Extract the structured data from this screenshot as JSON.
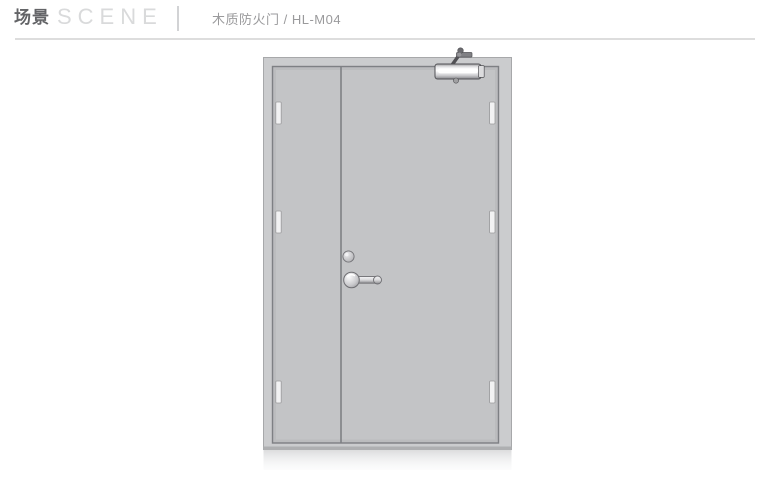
{
  "header": {
    "title_cn": "场景",
    "title_en": "SCENE",
    "product_label": "木质防火门 / HL-M04"
  },
  "illustration": {
    "name": "wooden-fire-door-closed-scene",
    "parts": [
      "door-frame",
      "left-leaf",
      "right-leaf",
      "meeting-stile",
      "hinge-left-top",
      "hinge-left-middle",
      "hinge-left-bottom",
      "hinge-right-top",
      "hinge-right-middle",
      "hinge-right-bottom",
      "door-closer",
      "lock-cylinder",
      "lever-handle",
      "floor-reflection"
    ]
  },
  "colors": {
    "background": "#ffffff",
    "frame": "#cbccce",
    "leaf": "#c3c4c6",
    "outline": "#7e8084",
    "header_title_cn": "#636467",
    "header_title_en": "#d9dadb",
    "product_label": "#9a9a9c",
    "divider": "#dddddd"
  }
}
